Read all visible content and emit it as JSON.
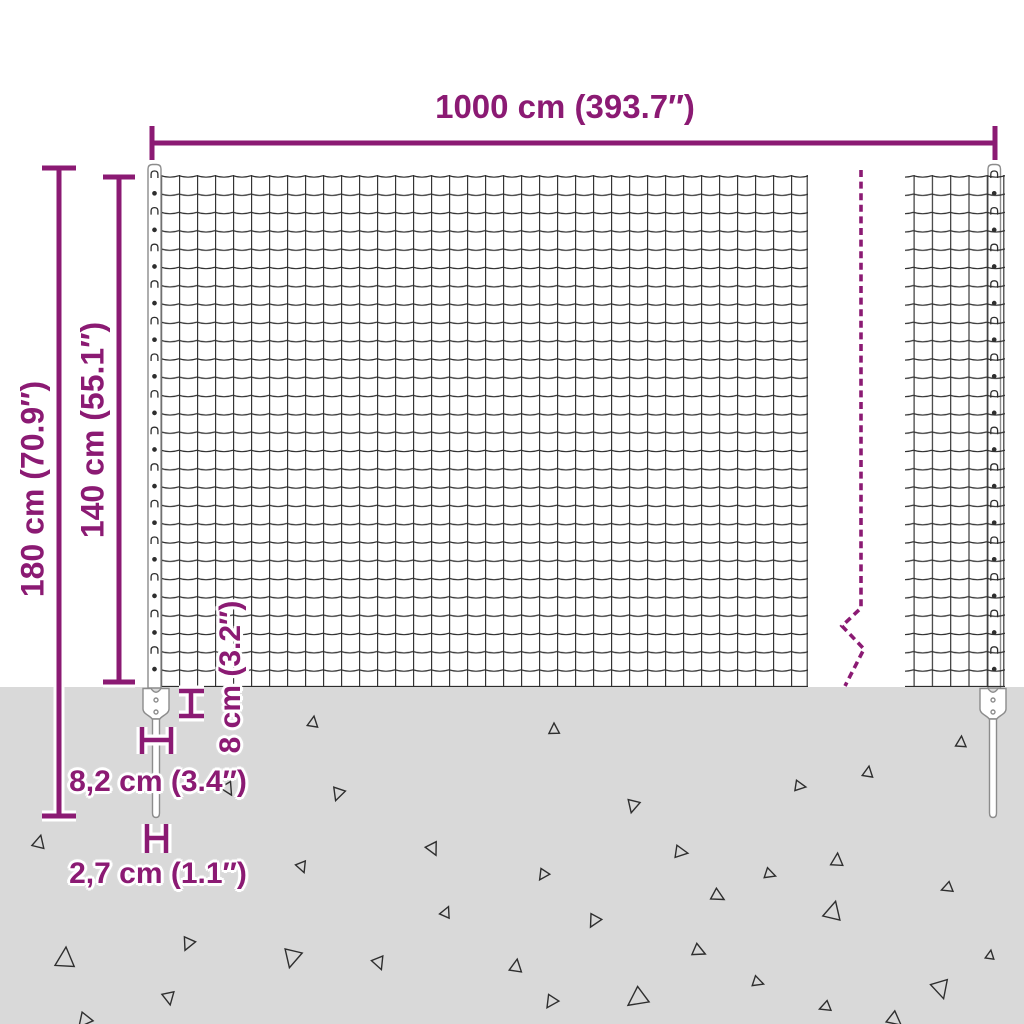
{
  "page": {
    "title": "Wire mesh fence with anchor spikes – dimension diagram"
  },
  "colors": {
    "accent": "#8b1a73",
    "wire": "#2e2e2e",
    "post_stroke": "#8c8c8c",
    "post_fill": "#ffffff",
    "ground": "#d9d9d9",
    "background": "#ffffff"
  },
  "dimensions": {
    "total_width": {
      "label": "1000 cm (393.7″)"
    },
    "total_height": {
      "label": "180 cm (70.9″)"
    },
    "mesh_height": {
      "label": "140 cm (55.1″)"
    },
    "anchor_depth": {
      "label": "8 cm (3.2″)"
    },
    "anchor_width": {
      "label": "8,2 cm (3.4″)"
    },
    "spike_width": {
      "label": "2,7 cm (1.1″)"
    }
  },
  "mesh": {
    "rows": 28,
    "cell_h": 18.3,
    "cell_w": 18.0,
    "post_clip_pattern": "alternating wire clips and dots"
  },
  "ground": {
    "top": 687,
    "triangles": [
      [
        313,
        722,
        6,
        10
      ],
      [
        338,
        794,
        7,
        200
      ],
      [
        39,
        842,
        7,
        15
      ],
      [
        302,
        867,
        6,
        160
      ],
      [
        433,
        849,
        7,
        155
      ],
      [
        446,
        912,
        6,
        25
      ],
      [
        65,
        958,
        11,
        5
      ],
      [
        188,
        944,
        7,
        205
      ],
      [
        292,
        958,
        10,
        195
      ],
      [
        379,
        963,
        7,
        160
      ],
      [
        169,
        998,
        7,
        170
      ],
      [
        84,
        1021,
        8,
        220
      ],
      [
        228,
        789,
        7,
        150
      ],
      [
        554,
        729,
        6,
        0
      ],
      [
        633,
        806,
        7,
        195
      ],
      [
        800,
        786,
        6,
        100
      ],
      [
        868,
        772,
        6,
        10
      ],
      [
        961,
        742,
        6,
        5
      ],
      [
        681,
        852,
        7,
        100
      ],
      [
        770,
        874,
        6,
        110
      ],
      [
        837,
        860,
        7,
        5
      ],
      [
        543,
        875,
        6,
        215
      ],
      [
        718,
        896,
        7,
        120
      ],
      [
        833,
        911,
        10,
        15
      ],
      [
        594,
        921,
        7,
        210
      ],
      [
        947,
        888,
        6,
        250
      ],
      [
        699,
        951,
        7,
        115
      ],
      [
        516,
        966,
        7,
        10
      ],
      [
        758,
        982,
        6,
        110
      ],
      [
        551,
        1002,
        7,
        215
      ],
      [
        637,
        999,
        11,
        235
      ],
      [
        825,
        1007,
        6,
        250
      ],
      [
        941,
        989,
        10,
        165
      ],
      [
        990,
        955,
        5,
        10
      ],
      [
        895,
        1020,
        8,
        130
      ]
    ]
  }
}
